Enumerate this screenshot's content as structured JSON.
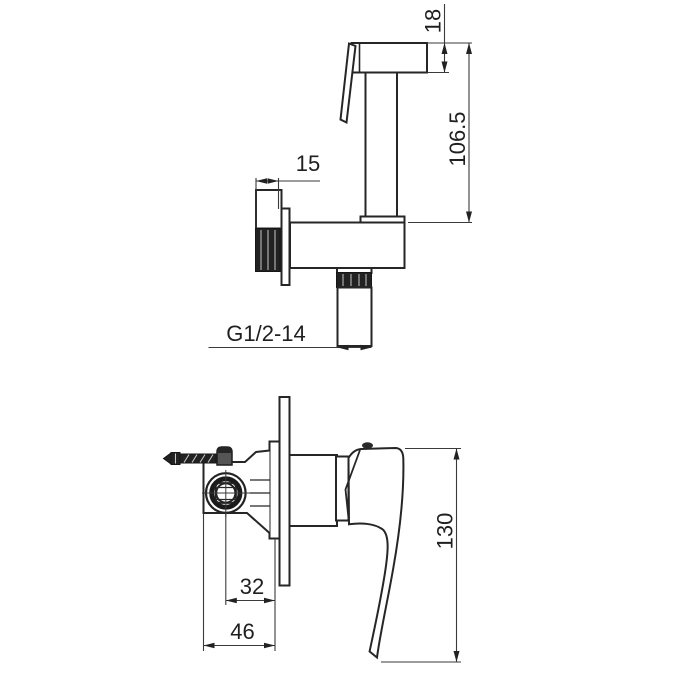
{
  "page": {
    "background": "#ffffff",
    "width": 700,
    "height": 700
  },
  "drawing": {
    "line_color": "#262626",
    "dark_fill": "#222222",
    "view_count": 2
  },
  "dims": {
    "head_height": "18",
    "overall_height": "106.5",
    "wall_offset": "15",
    "thread_callout": "G1/2-14",
    "center_depth": "32",
    "body_depth": "46",
    "handle_height": "130"
  }
}
